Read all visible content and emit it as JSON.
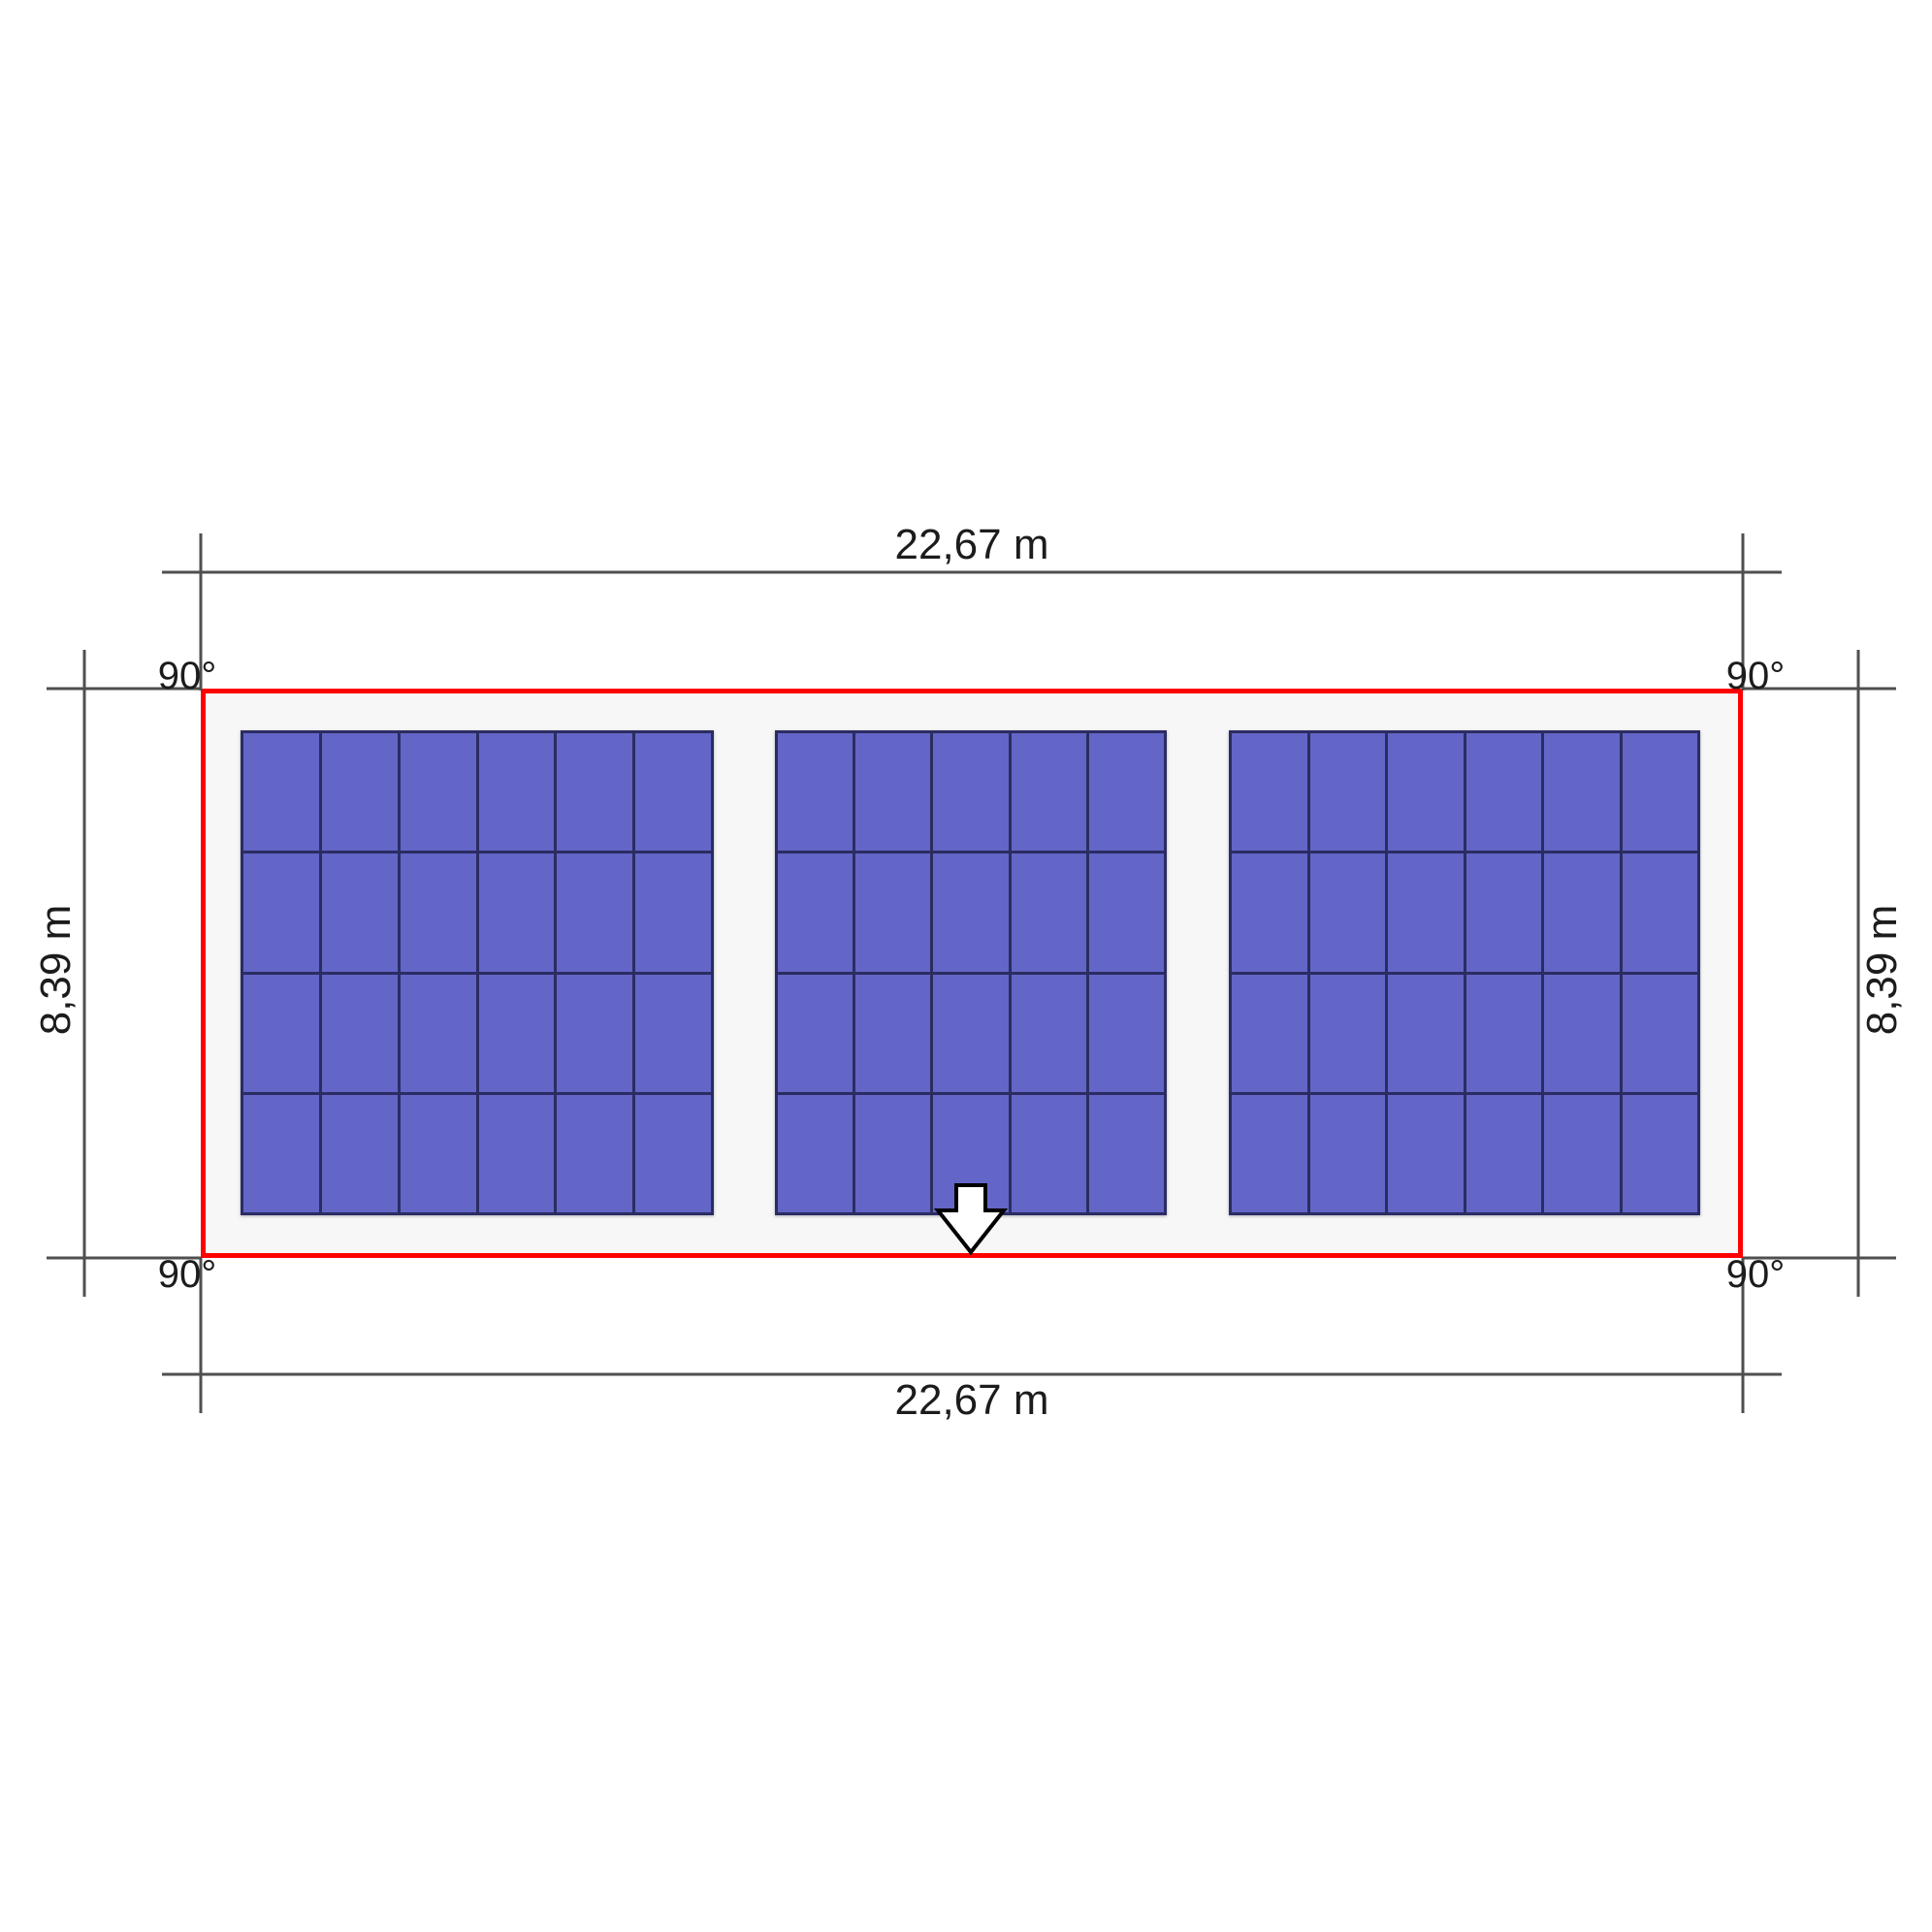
{
  "dimensions": {
    "width_top": "22,67 m",
    "width_bottom": "22,67 m",
    "height_left": "8,39 m",
    "height_right": "8,39 m"
  },
  "angles": {
    "top_left": "90°",
    "top_right": "90°",
    "bottom_left": "90°",
    "bottom_right": "90°"
  },
  "panel_groups": [
    {
      "name": "left",
      "columns": 6,
      "rows": 4
    },
    {
      "name": "middle",
      "columns": 5,
      "rows": 4
    },
    {
      "name": "right",
      "columns": 6,
      "rows": 4
    }
  ],
  "orientation_arrow": {
    "direction": "down"
  },
  "colors": {
    "roof-outline": "#ff0000",
    "roof-fill": "#f7f7f8",
    "panel-fill": "#6366c6",
    "panel-border": "#2b2c62",
    "dimension-line": "#4f4f4f",
    "text": "#1c1c1c",
    "arrow-fill": "#ffffff",
    "arrow-outline": "#000000",
    "page-bg": "#ffffff"
  }
}
